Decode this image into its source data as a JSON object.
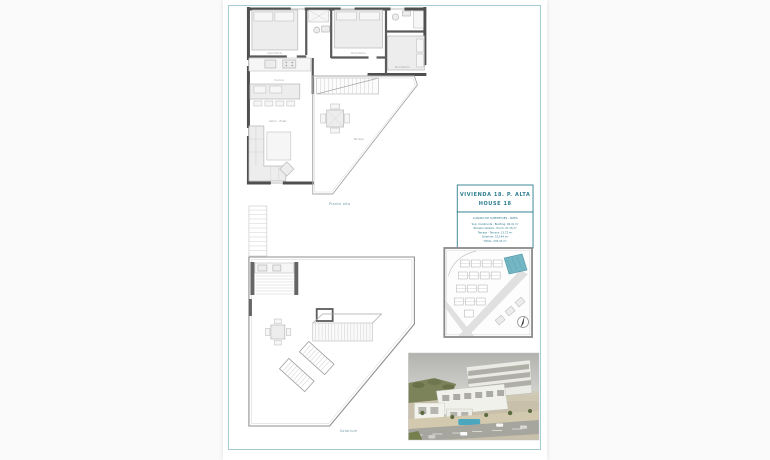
{
  "title_block": {
    "title": "VIVIENDA 18. P. ALTA",
    "subtitle": "HOUSE 18",
    "table": {
      "header": "CUADRO DE SUPERFICIES - SIZES",
      "rows": [
        "Sup. Construida - Building: 94,41 m²",
        "Terraza cubierta - Porch: 21,76 m²",
        "Terraza - Terrace: 13,72 m²",
        "Solarium: 103,44 m²",
        "TOTAL: 233,33 m²"
      ]
    }
  },
  "plan_labels": {
    "upper_floor": "Planta alta",
    "solarium": "Solarium"
  },
  "room_labels": [
    "Dormitorio",
    "Dormitorio",
    "Dormitorio",
    "Cocina",
    "Salón - Estar",
    "Terraza"
  ],
  "colors": {
    "accent": "#2d7c8e",
    "page_border": "#a5cbd3",
    "site_highlight": "#74b6c4",
    "pool": "#4aa7bd"
  }
}
